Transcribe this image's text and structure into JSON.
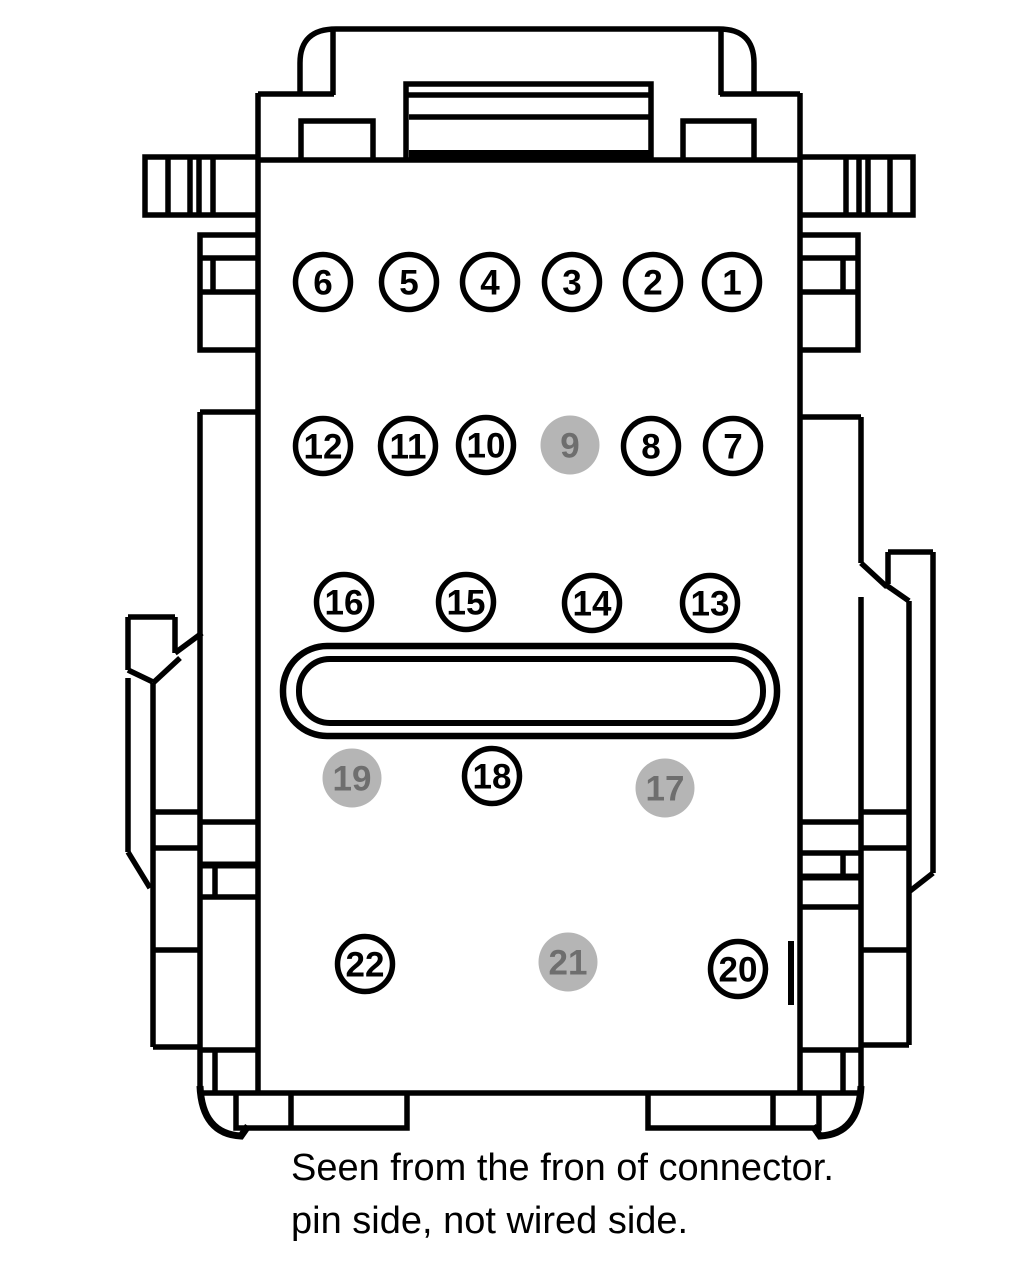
{
  "diagram": {
    "title_caption": {
      "line1": "Seen from the fron of connector.",
      "line2": "pin side, not wired side."
    },
    "colors": {
      "line": "#000000",
      "pin_fill": "#ffffff",
      "pin_outline": "#000000",
      "pin_text": "#000000",
      "disabled_pin_fill": "#b5b5b5",
      "disabled_pin_text": "#6e6e6e",
      "background": "#ffffff"
    },
    "pins": [
      {
        "n": 6,
        "x": 323,
        "y": 282,
        "disabled": false
      },
      {
        "n": 5,
        "x": 409,
        "y": 282,
        "disabled": false
      },
      {
        "n": 4,
        "x": 490,
        "y": 282,
        "disabled": false
      },
      {
        "n": 3,
        "x": 572,
        "y": 282,
        "disabled": false
      },
      {
        "n": 2,
        "x": 653,
        "y": 282,
        "disabled": false
      },
      {
        "n": 1,
        "x": 732,
        "y": 282,
        "disabled": false
      },
      {
        "n": 12,
        "x": 323,
        "y": 446,
        "disabled": false
      },
      {
        "n": 11,
        "x": 408,
        "y": 446,
        "disabled": false
      },
      {
        "n": 10,
        "x": 486,
        "y": 445,
        "disabled": false
      },
      {
        "n": 9,
        "x": 570,
        "y": 445,
        "disabled": true
      },
      {
        "n": 8,
        "x": 651,
        "y": 446,
        "disabled": false
      },
      {
        "n": 7,
        "x": 733,
        "y": 446,
        "disabled": false
      },
      {
        "n": 16,
        "x": 344,
        "y": 602,
        "disabled": false
      },
      {
        "n": 15,
        "x": 466,
        "y": 602,
        "disabled": false
      },
      {
        "n": 14,
        "x": 592,
        "y": 603,
        "disabled": false
      },
      {
        "n": 13,
        "x": 710,
        "y": 603,
        "disabled": false
      },
      {
        "n": 19,
        "x": 352,
        "y": 778,
        "disabled": true
      },
      {
        "n": 18,
        "x": 492,
        "y": 776,
        "disabled": false
      },
      {
        "n": 17,
        "x": 665,
        "y": 788,
        "disabled": true
      },
      {
        "n": 22,
        "x": 365,
        "y": 964,
        "disabled": false
      },
      {
        "n": 21,
        "x": 568,
        "y": 962,
        "disabled": true
      },
      {
        "n": 20,
        "x": 738,
        "y": 969,
        "disabled": false
      }
    ],
    "pin_style": {
      "radius": 27.5,
      "radius_disabled": 29.5,
      "stroke_width": 5.5
    }
  }
}
